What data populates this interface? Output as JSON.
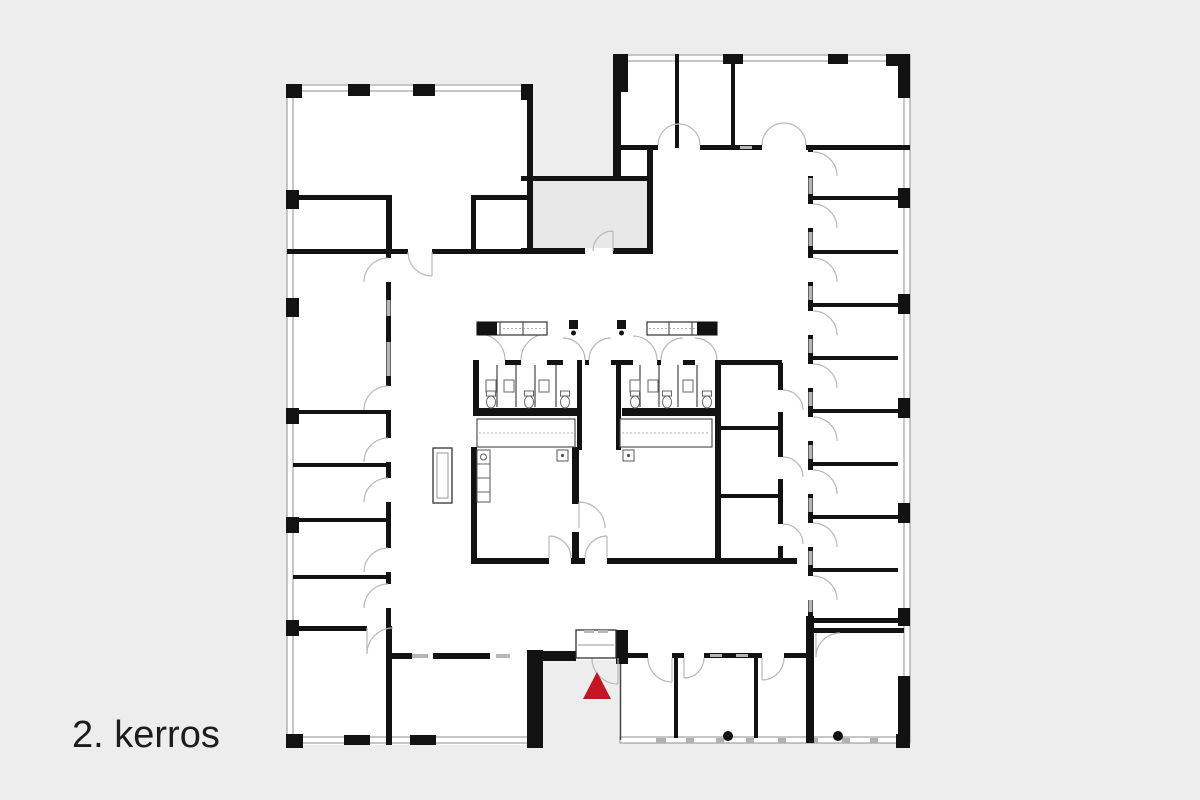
{
  "canvas": {
    "background": "#ededee"
  },
  "floor_plan": {
    "label": "2. kerros",
    "label_color": "#1c1c1c",
    "marker": {
      "type": "entrance-marker",
      "color": "#c31622"
    },
    "colors": {
      "walls": "#121212",
      "floor": "#ffffff",
      "doors": "#b9b9b9",
      "void_area": "#e8e8e9",
      "window_line": "#8e8e8e"
    }
  }
}
